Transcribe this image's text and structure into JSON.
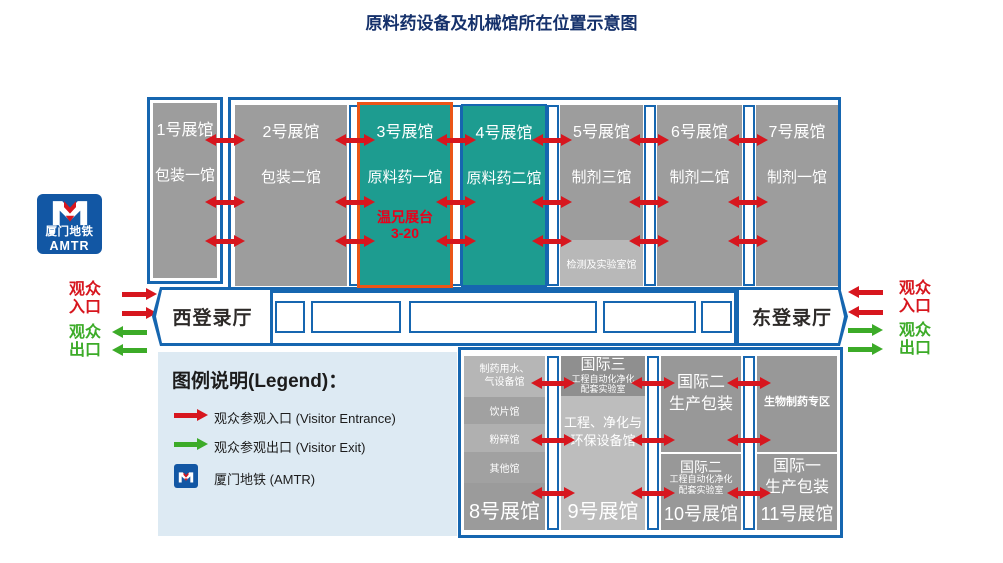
{
  "title": "原料药设备及机械馆所在位置示意图",
  "halls_top": [
    {
      "no": "1号展馆",
      "name": "包装一馆"
    },
    {
      "no": "2号展馆",
      "name": "包装二馆"
    },
    {
      "no": "3号展馆",
      "name": "原料药一馆",
      "booth_name": "温兄展台",
      "booth_no": "3-20"
    },
    {
      "no": "4号展馆",
      "name": "原料药二馆"
    },
    {
      "no": "5号展馆",
      "name": "制剂三馆",
      "sub": "检测及实验室馆"
    },
    {
      "no": "6号展馆",
      "name": "制剂二馆"
    },
    {
      "no": "7号展馆",
      "name": "制剂一馆"
    }
  ],
  "registration": {
    "west": "西登录厅",
    "east": "东登录厅"
  },
  "flow": {
    "entrance": "观众\n入口",
    "exit": "观众\n出口"
  },
  "metro": {
    "name": "厦门地铁",
    "abbr": "AMTR"
  },
  "legend": {
    "title": "图例说明(Legend)：",
    "entrance": "观众参观入口 (Visitor Entrance)",
    "exit": "观众参观出口 (Visitor Exit)",
    "metro": "厦门地铁 (AMTR)"
  },
  "halls_bottom": [
    {
      "no": "8号展馆",
      "segments": [
        "制药用水、\n气设备馆",
        "饮片馆",
        "粉碎馆",
        "其他馆"
      ]
    },
    {
      "no": "9号展馆",
      "top_title": "国际三",
      "top_sub": "工程自动化净化\n配套实验室",
      "body": "工程、净化与\n环保设备馆"
    },
    {
      "no": "10号展馆",
      "upper": "国际二\n生产包装",
      "lower_title": "国际二",
      "lower_sub": "工程自动化净化\n配套实验室"
    },
    {
      "no": "11号展馆",
      "upper": "生物制药专区",
      "lower": "国际一\n生产包装"
    }
  ],
  "colors": {
    "border_blue": "#1666b0",
    "teal": "#1d9c90",
    "orange": "#ea5517",
    "red": "#d7161e",
    "green": "#3cab28"
  }
}
